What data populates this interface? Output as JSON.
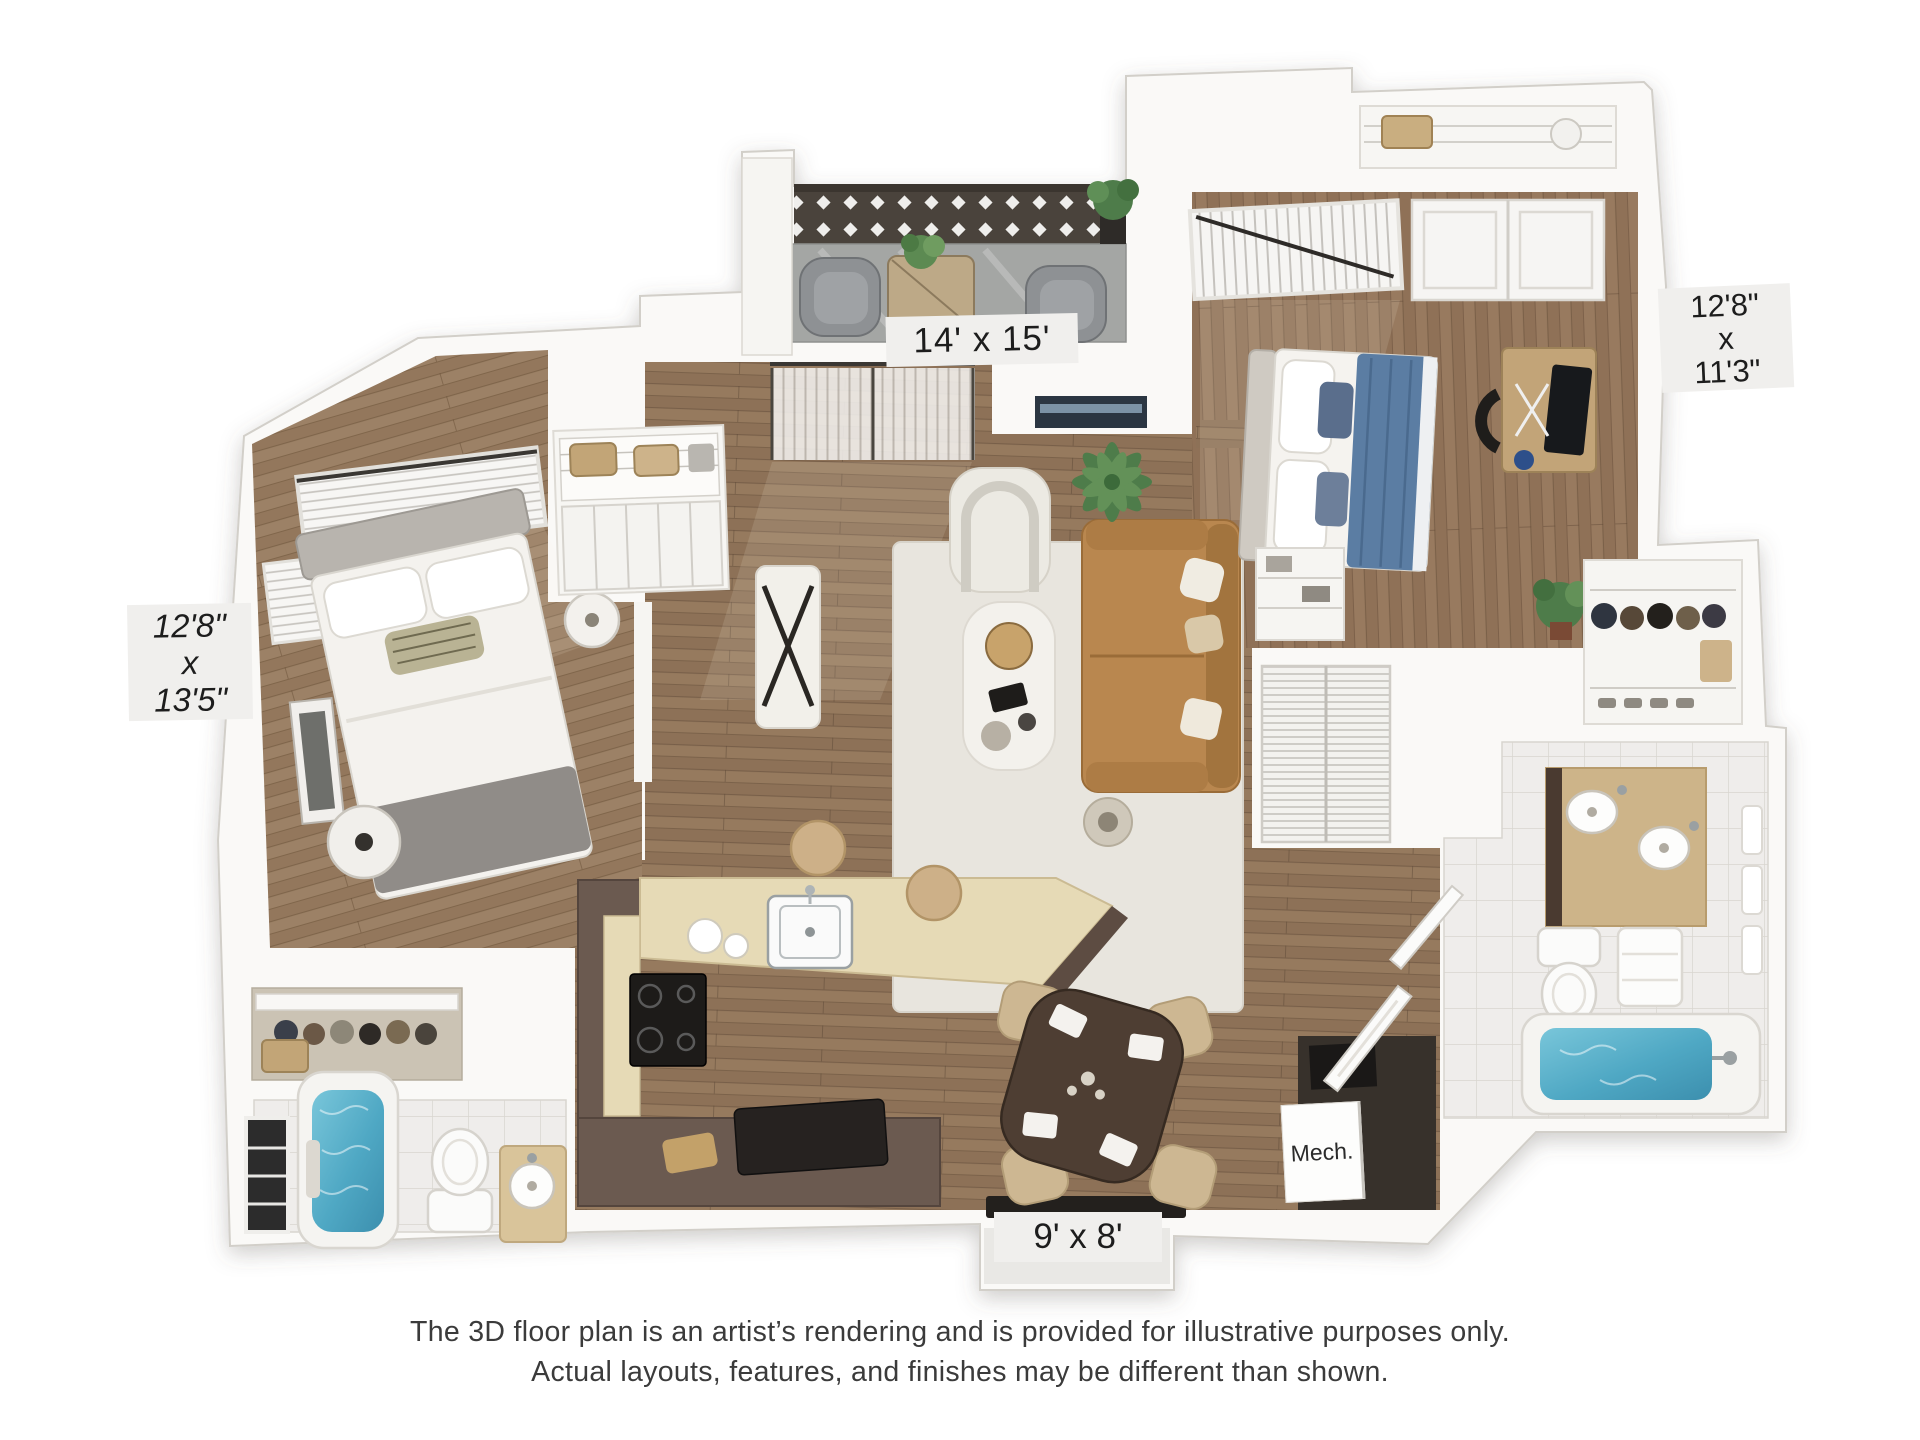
{
  "labels": {
    "living": "14' x 15'",
    "bedroom_right": [
      "12'8\"",
      "x",
      "11'3\""
    ],
    "bedroom_left": [
      "12'8\"",
      "x",
      "13'5\""
    ],
    "patio": "9' x 8'",
    "mech": "Mech."
  },
  "disclaimer": {
    "line1": "The 3D floor plan is an artist’s rendering and is provided for illustrative purposes only.",
    "line2": "Actual layouts, features, and finishes may be different than shown."
  },
  "colors": {
    "background": "#ffffff",
    "wall": "#faf9f7",
    "wall_edge": "#d2cfc9",
    "wood_floor": "#8d7157",
    "balcony_floor": "#a4a6a4",
    "lattice": "#4a433c",
    "tile": "#efedeb",
    "rug": "#e8e5de",
    "sofa": "#b9874f",
    "armchair": "#eceae3",
    "bed_duvet_blue": "#5b7da3",
    "tub_water": "#4fa8c4",
    "kitchen_cabinets": "#6b5a50",
    "countertop": "#e6dab6",
    "dining_chairs": "#cdb792",
    "mech_floor": "#37312b",
    "label_background": "#f0efed",
    "label_text": "#1d1d1d",
    "disclaimer_text": "#3b3b3b"
  }
}
